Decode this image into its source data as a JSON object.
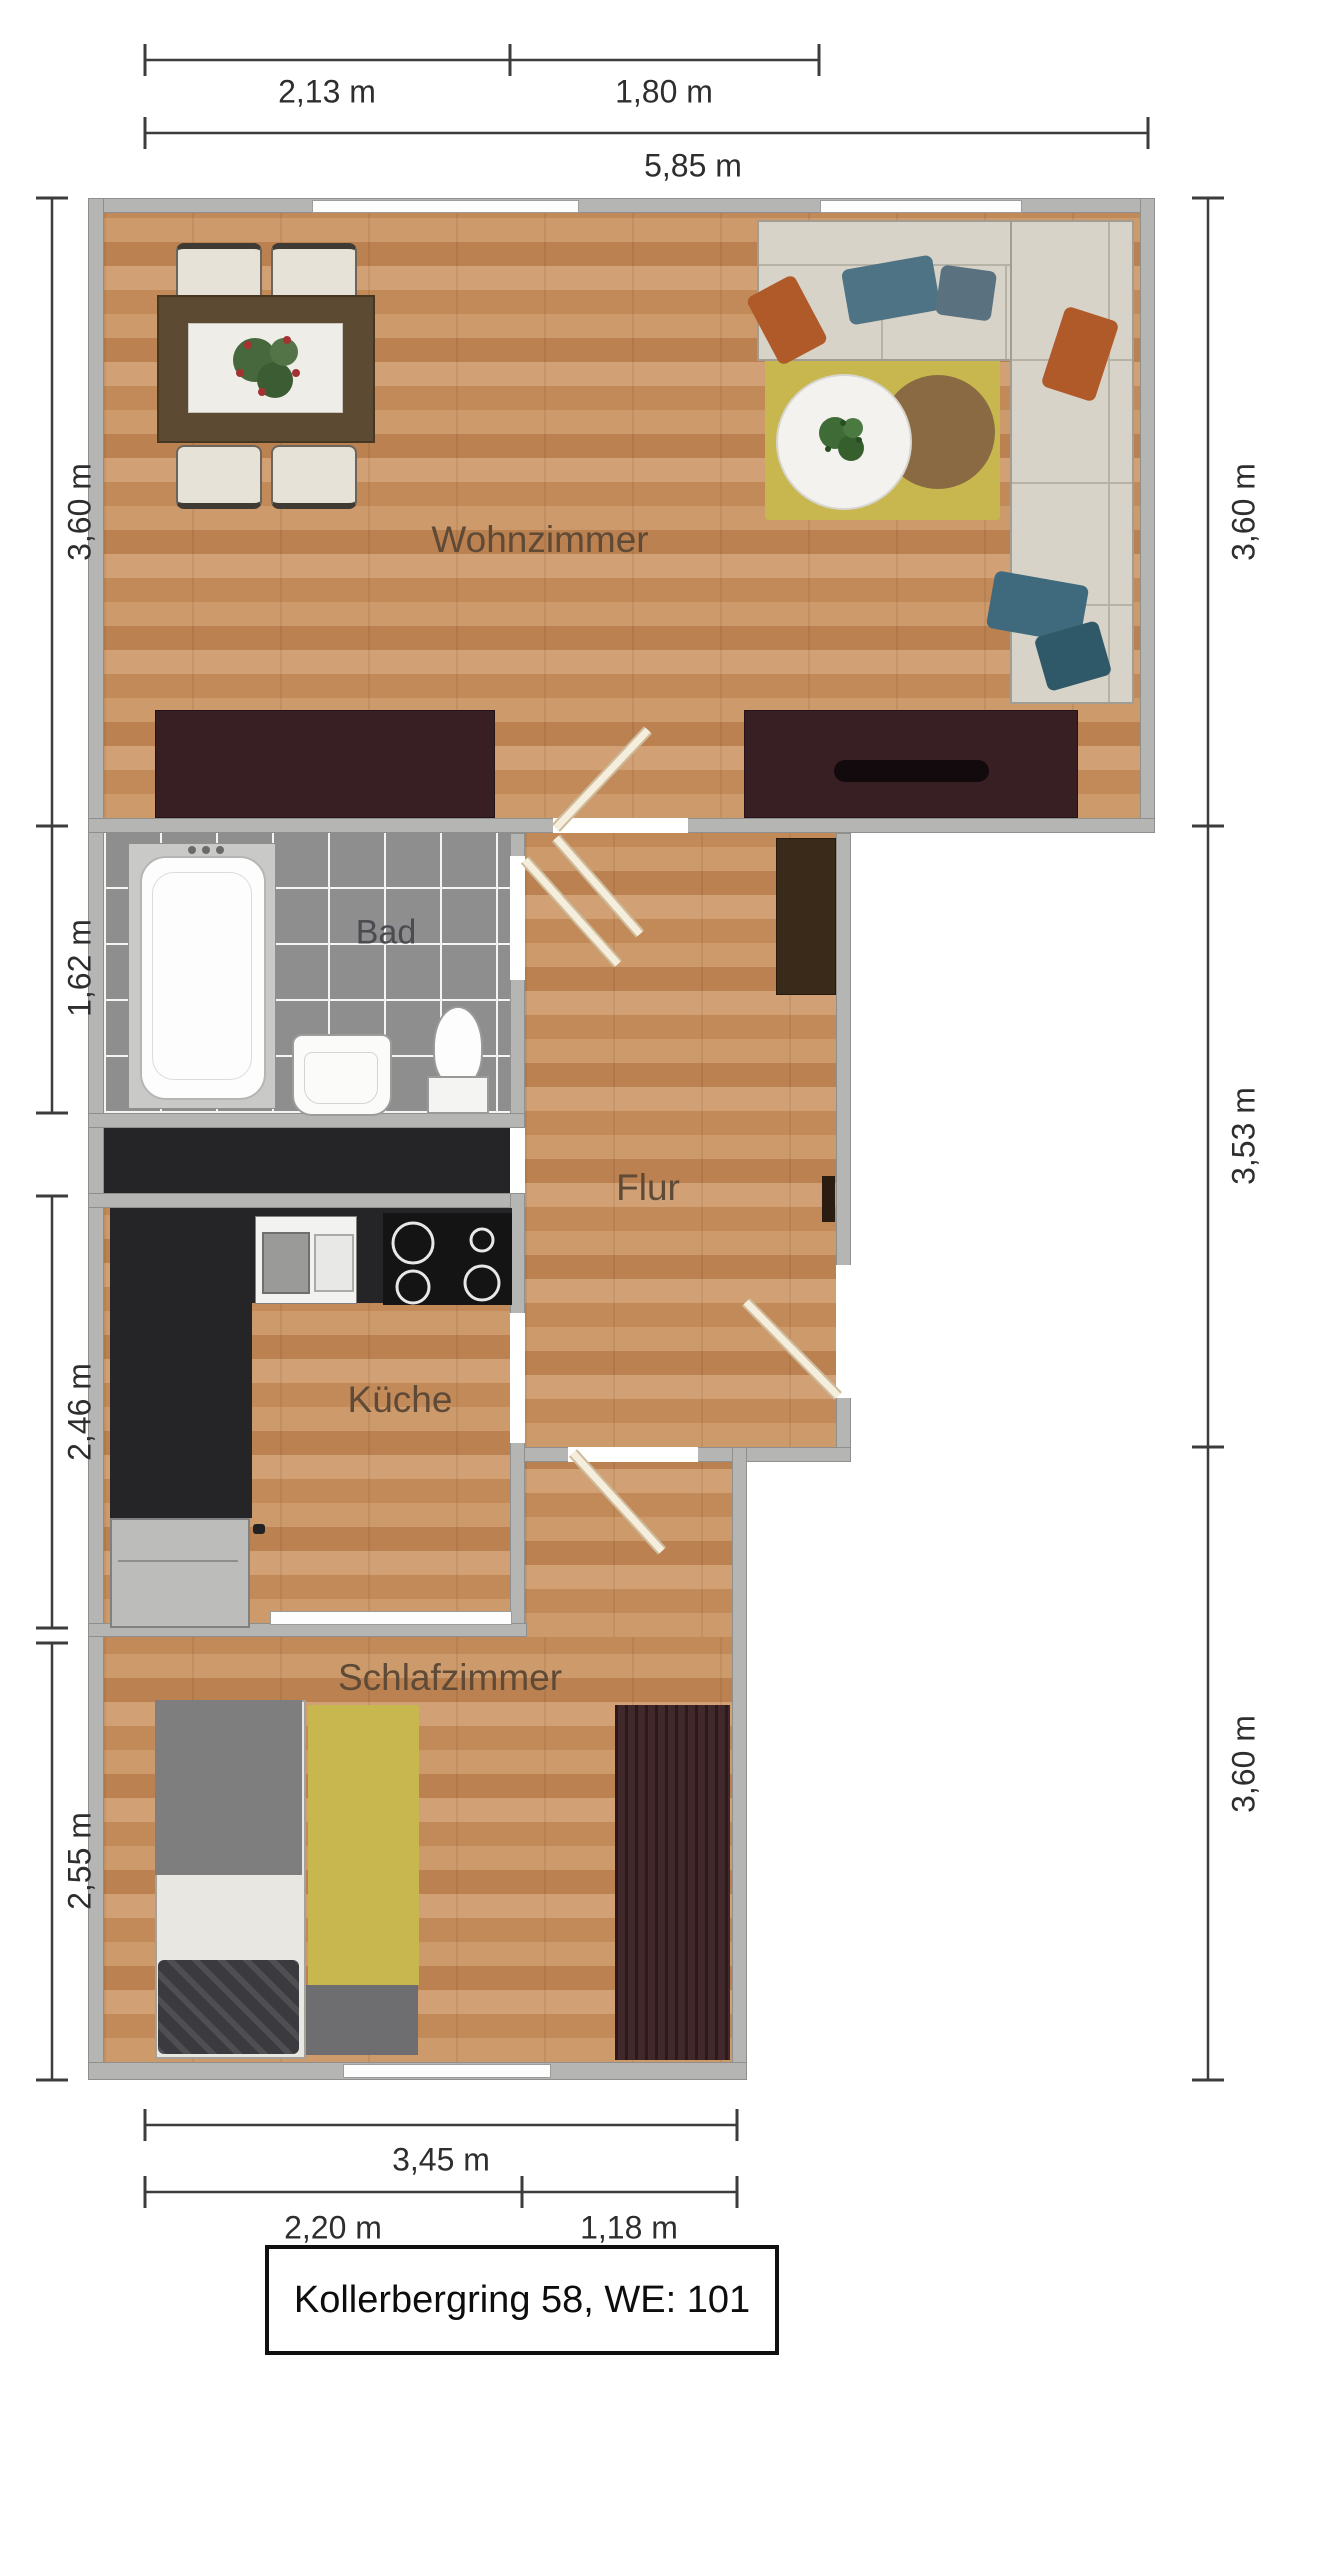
{
  "title_box": {
    "text": "Kollerbergring 58, WE: 101"
  },
  "rooms": {
    "wohnzimmer": {
      "label": "Wohnzimmer"
    },
    "bad": {
      "label": "Bad"
    },
    "flur": {
      "label": "Flur"
    },
    "kueche": {
      "label": "Küche"
    },
    "schlafzimmer": {
      "label": "Schlafzimmer"
    }
  },
  "dimensions": {
    "top_segment_1": "2,13 m",
    "top_segment_2": "1,80 m",
    "top_total": "5,85 m",
    "left_wohnzimmer": "3,60 m",
    "left_bad": "1,62 m",
    "left_kueche": "2,46 m",
    "left_schlafzimmer": "2,55 m",
    "right_wohnzimmer": "3,60 m",
    "right_flur": "3,53 m",
    "right_schlafzimmer": "3,60 m",
    "bottom_total": "3,45 m",
    "bottom_segment_1": "2,20 m",
    "bottom_segment_2": "1,18 m"
  },
  "colors": {
    "wall": "#b5b5b3",
    "wood_floor": "#c6905f",
    "bath_tile": "#8e8e8e",
    "dark_furniture": "#381f24",
    "kitchen_counter": "#252527",
    "rug_yellow": "#c7b74e",
    "sofa_beige": "#d7d3c8",
    "pillow_orange": "#b05a2a",
    "pillow_blue": "#4e7384",
    "dimension_text": "#2e2e2e",
    "room_label_text": "#5e4a36"
  }
}
